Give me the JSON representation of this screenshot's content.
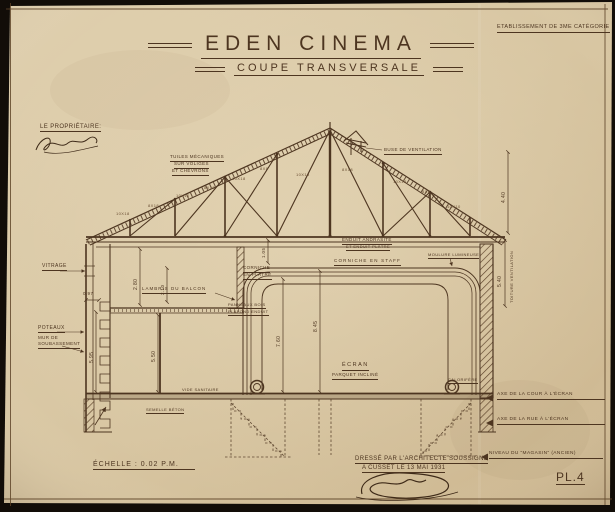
{
  "colors": {
    "paper": "#d8c6a2",
    "ink": "#4d3520",
    "ink-soft": "#6a4f33",
    "photo": "#120d08"
  },
  "header": {
    "classification": "Etablissement de 3me Catégorie",
    "title": "EDEN CINEMA",
    "subtitle": "COUPE TRANSVERSALE"
  },
  "proprietor_label": "Le Propriétaire:",
  "roof": {
    "tiles_line1": "Tuiles Mécaniques",
    "tiles_line2": "sur voliges",
    "tiles_line3": "et chevrons",
    "ventilation": "Buse de Ventilation",
    "truss_marks": [
      "10x18",
      "8x18",
      "10x10",
      "8x18",
      "10x18",
      "8x8",
      "10x18",
      "8x18",
      "10x18",
      "8x8",
      "10x10"
    ]
  },
  "ceiling": {
    "plaster_line1": "Enduit Andrasite",
    "plaster_line2": "et enduit plâtre",
    "cornice": "Corniche en staff",
    "cornice_left_line1": "Corniche",
    "cornice_left_line2": "en plâtre",
    "light_moulding": "Moulure Lumineuse"
  },
  "left": {
    "glazing": "Vitrage",
    "balcony_panel": "Lambris du Balcon",
    "wood_panels": "Panneaux bois",
    "plaster_ceiling": "Plafond enduit",
    "posts": "Poteaux",
    "basement_wall_line1": "Mur de",
    "basement_wall_line2": "Soubassement"
  },
  "hall": {
    "screen": "ÉCRAN",
    "sloped_floor": "Parquet incliné",
    "void": "Vide Sanitaire",
    "footing": "Semelle Béton",
    "heater": "Calorifère"
  },
  "dimensions": {
    "right_top": "4.40",
    "vent_height": "5.40",
    "vent_label": "Toiture Ventilation",
    "cove_height": "7.60",
    "hall_height": "8.45",
    "balcony_height": "2.80",
    "gallery_height": "5.50",
    "stair_height": "5.95",
    "balcony_clear": "2.10",
    "ceiling_drop": "1.05",
    "wall_offset": "0.97"
  },
  "levels": {
    "axis_court": "Axe de la Cour à l'Écran",
    "axis_street": "Axe de la Rue à l'Écran",
    "store_level": "Niveau du \"Magasin\" (ancien)"
  },
  "footer": {
    "scale": "ÉCHELLE : 0.02 P.M.",
    "drafted_line1": "Dressé par l'Architecte soussigné",
    "drafted_line2": "A Cusset le 13 Mai 1931",
    "plate": "PL.4"
  }
}
